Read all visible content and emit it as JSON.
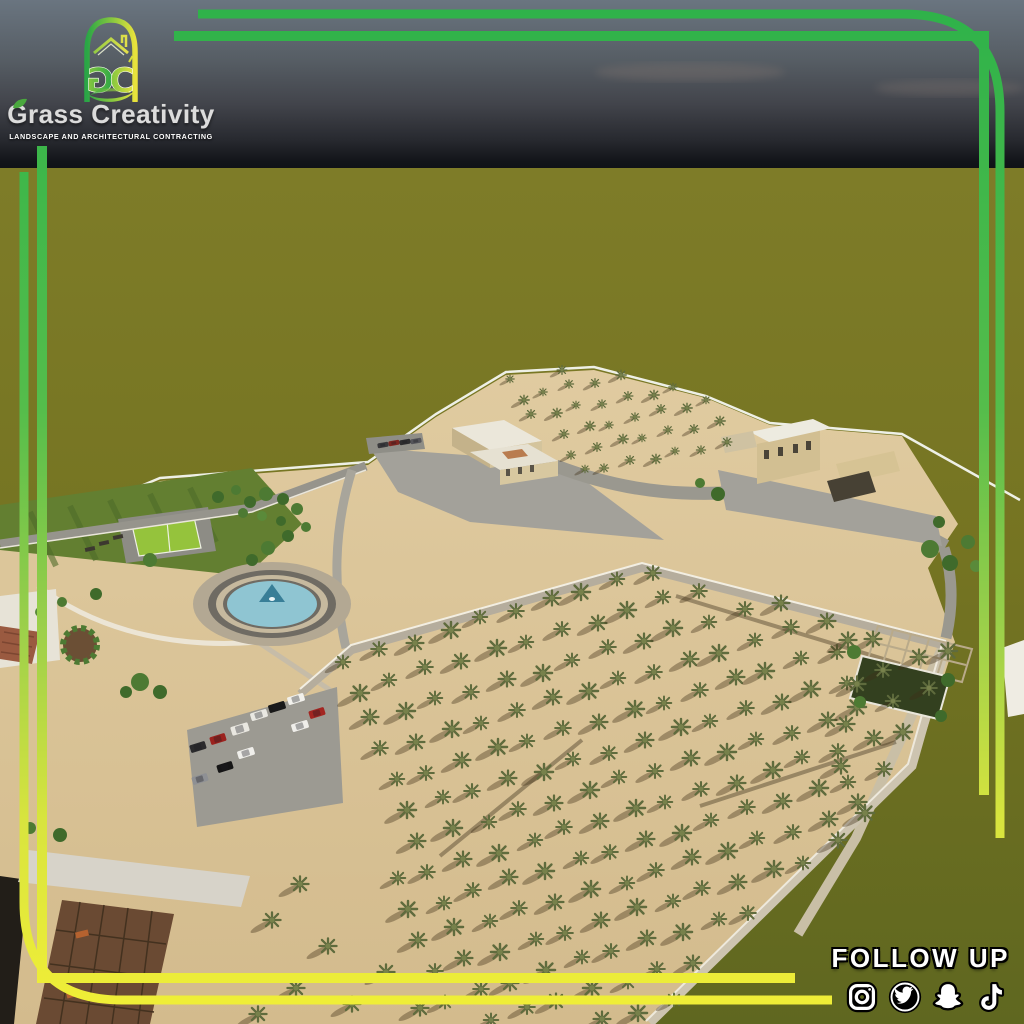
{
  "brand": {
    "name": "Grass Creativity",
    "tagline": "LANDSCAPE AND ARCHITECTURAL CONTRACTING",
    "monogram_g": "G",
    "monogram_c": "C"
  },
  "footer": {
    "follow_label": "FOLLOW UP",
    "social": [
      {
        "name": "instagram"
      },
      {
        "name": "twitter"
      },
      {
        "name": "snapchat"
      },
      {
        "name": "tiktok"
      }
    ]
  },
  "palette": {
    "frame_green": "#2eb24a",
    "frame_yellow": "#f2ef36",
    "sky_top": "#6a7580",
    "sky_horizon": "#0d1014",
    "grass_field": "#7b7a26",
    "sand": "#dbc79b",
    "water": "#8fc5d2",
    "road": "#a3a19a",
    "path_white": "#f0ece0",
    "logo_green": "#2aa646",
    "logo_yellow": "#e8e23c"
  },
  "scene": {
    "palm_colors": {
      "frond": "#5f6b3d",
      "crown": "#77814b",
      "shadow": "rgba(64,48,24,0.38)"
    },
    "shrub_colors": [
      "#4d7a33",
      "#3f6a2b",
      "#5a8a3a"
    ],
    "palm_grids": [
      {
        "name": "north-orchard",
        "base": [
          480,
          362
        ],
        "u": [
          24,
          -5
        ],
        "cols": 12,
        "v": [
          9,
          20
        ],
        "rows": 7,
        "scale": 0.55,
        "clip": [
          [
            496,
            378
          ],
          [
            598,
            362
          ],
          [
            714,
            398
          ],
          [
            760,
            468
          ],
          [
            584,
            470
          ]
        ]
      },
      {
        "name": "main-orchard",
        "base": [
          300,
          640
        ],
        "u": [
          34,
          -10
        ],
        "cols": 20,
        "v": [
          12,
          30
        ],
        "rows": 16,
        "scale": 0.95,
        "clip": [
          [
            334,
            654
          ],
          [
            644,
            560
          ],
          [
            952,
            650
          ],
          [
            912,
            772
          ],
          [
            648,
            1026
          ],
          [
            426,
            1026
          ]
        ]
      }
    ],
    "palm_singles": [
      [
        848,
        640
      ],
      [
        857,
        684
      ],
      [
        846,
        724
      ],
      [
        841,
        766
      ],
      [
        858,
        802
      ],
      [
        838,
        840
      ],
      [
        300,
        884
      ],
      [
        272,
        920
      ],
      [
        328,
        946
      ],
      [
        296,
        988
      ],
      [
        352,
        1004
      ],
      [
        258,
        1014
      ],
      [
        386,
        972
      ],
      [
        420,
        1008
      ]
    ],
    "shrubs": [
      [
        150,
        560,
        7,
        0
      ],
      [
        96,
        594,
        6,
        1
      ],
      [
        62,
        602,
        5,
        0
      ],
      [
        40,
        612,
        5,
        2
      ],
      [
        252,
        560,
        6,
        1
      ],
      [
        268,
        548,
        7,
        0
      ],
      [
        288,
        536,
        6,
        1
      ],
      [
        306,
        527,
        5,
        0
      ],
      [
        140,
        682,
        9,
        0
      ],
      [
        160,
        692,
        7,
        1
      ],
      [
        126,
        692,
        6,
        1
      ],
      [
        250,
        502,
        6,
        1
      ],
      [
        266,
        494,
        7,
        0
      ],
      [
        283,
        499,
        6,
        1
      ],
      [
        297,
        509,
        6,
        0
      ],
      [
        262,
        516,
        5,
        2
      ],
      [
        281,
        521,
        5,
        1
      ],
      [
        243,
        513,
        5,
        0
      ],
      [
        930,
        549,
        9,
        0
      ],
      [
        950,
        563,
        8,
        1
      ],
      [
        968,
        542,
        7,
        0
      ],
      [
        939,
        522,
        6,
        1
      ],
      [
        976,
        566,
        6,
        2
      ],
      [
        718,
        494,
        7,
        1
      ],
      [
        700,
        483,
        5,
        0
      ],
      [
        854,
        652,
        7,
        0
      ],
      [
        948,
        680,
        7,
        1
      ],
      [
        860,
        702,
        6,
        0
      ],
      [
        941,
        716,
        6,
        1
      ],
      [
        218,
        497,
        6,
        1
      ],
      [
        236,
        490,
        5,
        0
      ],
      [
        60,
        835,
        7,
        1
      ],
      [
        30,
        828,
        6,
        0
      ]
    ],
    "benches": [
      [
        104,
        543
      ],
      [
        90,
        549
      ],
      [
        118,
        537
      ]
    ],
    "loungers": [
      [
        82,
        934
      ],
      [
        73,
        994
      ]
    ],
    "cars": [
      [
        383,
        445,
        11,
        5,
        -10,
        "#3a3a3c"
      ],
      [
        394,
        443,
        11,
        5,
        -10,
        "#7e2620"
      ],
      [
        405,
        442,
        11,
        5,
        -10,
        "#2e2e30"
      ],
      [
        416,
        441,
        11,
        5,
        -10,
        "#55555a"
      ],
      [
        296,
        699,
        17,
        8,
        -17,
        "#f2f1ec"
      ],
      [
        277,
        707,
        17,
        8,
        -17,
        "#191919"
      ],
      [
        259,
        715,
        17,
        8,
        -17,
        "#e9e8e2"
      ],
      [
        317,
        713,
        16,
        8,
        -17,
        "#a32622"
      ],
      [
        300,
        726,
        17,
        8,
        -17,
        "#efeeea"
      ],
      [
        240,
        729,
        18,
        9,
        -17,
        "#e9e7e0"
      ],
      [
        218,
        739,
        16,
        8,
        -17,
        "#9b221e"
      ],
      [
        198,
        747,
        16,
        8,
        -17,
        "#2b2b2d"
      ],
      [
        246,
        753,
        17,
        8,
        -17,
        "#f0efeb"
      ],
      [
        225,
        767,
        16,
        8,
        -17,
        "#161616"
      ],
      [
        200,
        779,
        16,
        8,
        -17,
        "#8e9094"
      ]
    ]
  }
}
